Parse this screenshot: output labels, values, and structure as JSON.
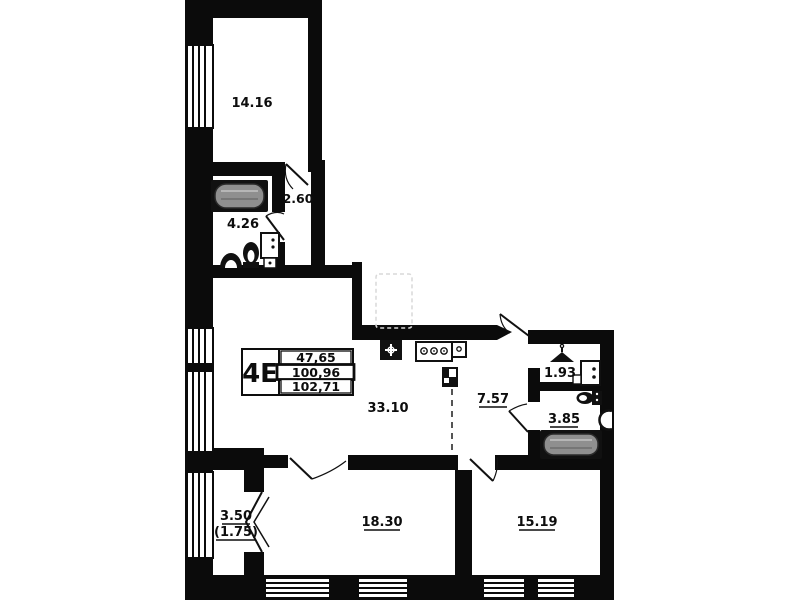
{
  "plan_title": "apartment floor plan 4E",
  "unit": {
    "code": "4E",
    "living_area": "47,65",
    "apartment_area": "100,96",
    "total_area": "102,71"
  },
  "rooms": {
    "bedroom_top": "14.16",
    "corridor_small": "2.60",
    "bathroom_top": "4.26",
    "living_kitchen": "33.10",
    "hallway": "7.57",
    "wardrobe": "1.93",
    "bathroom_right": "3.85",
    "bedroom_bottom_left": "18.30",
    "bedroom_bottom_right": "15.19",
    "balcony_area": "3.50",
    "balcony_reduced_area": "(1.75)"
  },
  "colors": {
    "wall": "#0b0b0b",
    "background": "#ffffff",
    "tub_fill": "#8f8f8f",
    "fridge_dash": "#d8d8d8"
  }
}
